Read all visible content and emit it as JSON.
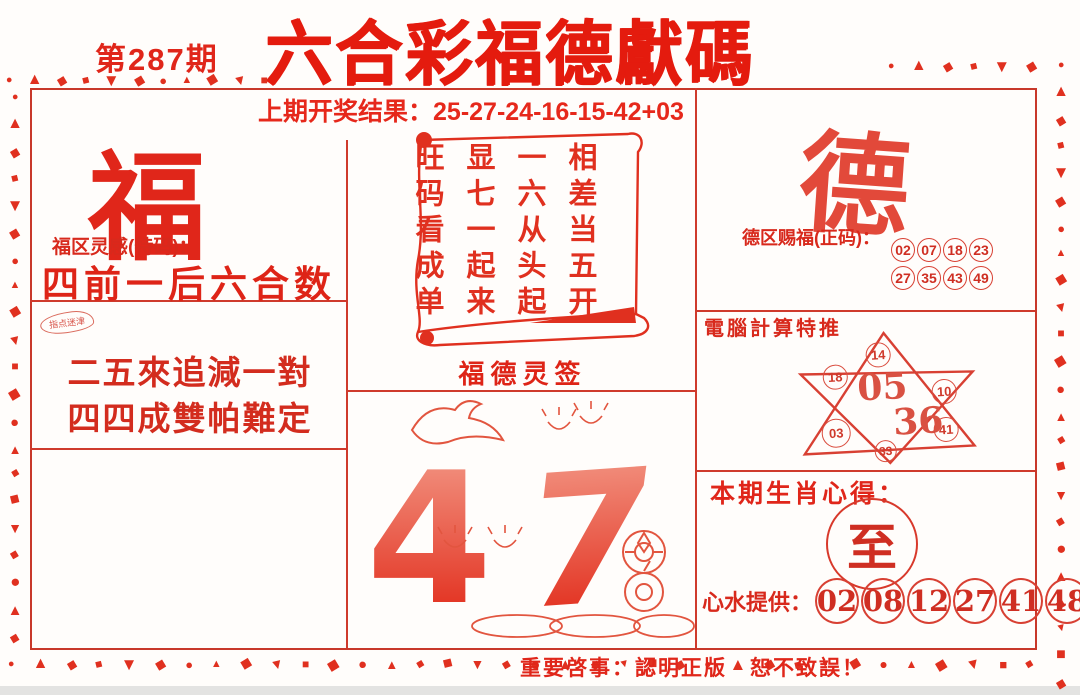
{
  "header": {
    "issue": "第287期",
    "title": "六合彩福德獻碼",
    "last_result_label": "上期开奖结果：",
    "last_result": "25-27-24-16-15-42+03"
  },
  "fu_section": {
    "big_char": "福",
    "hint_label": "福区灵感(特码)：",
    "hint_text": "四前一后六合数",
    "stamp_text": "指点迷津",
    "poem_line1": "二五來追減一對",
    "poem_line2": "四四成雙帕難定"
  },
  "scroll_section": {
    "caption": "福德灵签",
    "columns": [
      "相差当五开",
      "一六从头起",
      "显七一起来",
      "旺码看成单"
    ]
  },
  "illustration": {
    "number_left": "4",
    "number_right": "7"
  },
  "de_section": {
    "big_char": "德",
    "zheng_label": "德区赐福(正码)：",
    "zheng_row1": [
      "02",
      "07",
      "18",
      "23"
    ],
    "zheng_row2": [
      "27",
      "35",
      "43",
      "49"
    ],
    "computer_label": "電腦計算特推",
    "star": {
      "top": "14",
      "upper_left": "18",
      "upper_right": "10",
      "center_a": "05",
      "center_b": "36",
      "lower_left": "03",
      "lower_right": "41",
      "bottom": "33"
    },
    "zodiac_label": "本期生肖心得：",
    "zodiac_char": "至",
    "tips_label": "心水提供：",
    "tips_numbers": [
      "02",
      "08",
      "12",
      "27",
      "41",
      "48"
    ]
  },
  "footer": {
    "notice": "重要啓事：認明正版　恕不致誤！"
  },
  "colors": {
    "primary_red": "#e2261a",
    "dark_red": "#cf2e22",
    "light_red": "#f4a08e"
  },
  "decor": {
    "border_shapes": "●▲◆■▼◆●▲◆▼■◆"
  }
}
